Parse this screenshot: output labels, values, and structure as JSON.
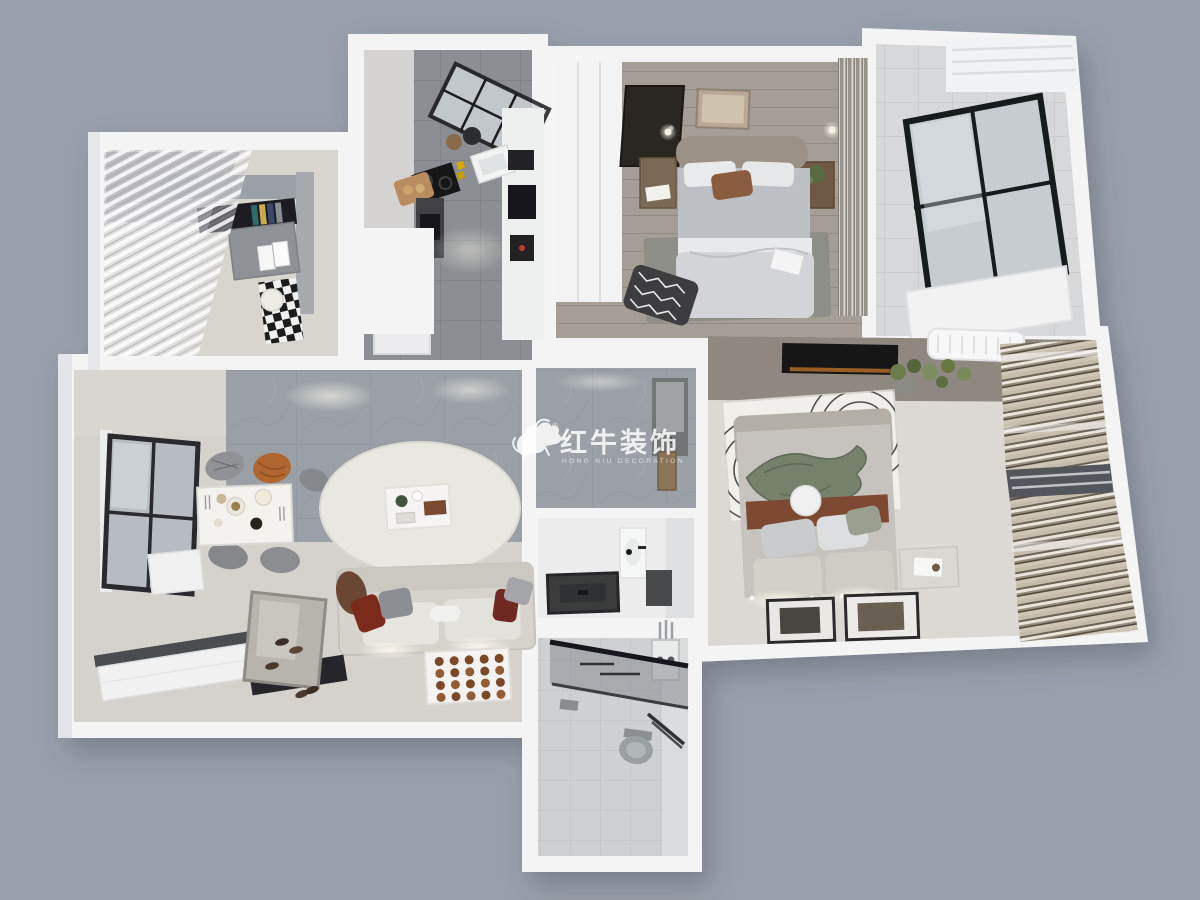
{
  "scene": {
    "type": "3d-floorplan-render",
    "description": "Photorealistic top-down 3D render of an apartment interior",
    "rooms": [
      {
        "id": "study-balcony"
      },
      {
        "id": "kitchen"
      },
      {
        "id": "bedroom-secondary"
      },
      {
        "id": "balcony-side"
      },
      {
        "id": "bedroom-master"
      },
      {
        "id": "living-dining"
      },
      {
        "id": "hallway"
      },
      {
        "id": "bathroom-vanity"
      },
      {
        "id": "bathroom-shower"
      }
    ]
  },
  "watermark": {
    "logo": "bull-logo",
    "registered": "®",
    "title": "红牛装饰",
    "subtitle": "HONG NIU DECORATION",
    "color": "#ffffff"
  },
  "palette": {
    "background": "#9aa0ab",
    "wall": "#f4f4f5",
    "wall_shade": "#e0e1e4",
    "study_floor": "#d8d5cf",
    "kitchen_floor": "#8b8e92",
    "bedroom1_floor": "#a49e96",
    "master_floor": "#dcd9d4",
    "master_wall": "#8f8880",
    "living_floor": "#d5d2ce",
    "marble_wall": "#9aa0a6",
    "balcony_tile": "#d7d8da",
    "bath_floor": "#ececed",
    "shower_tile": "#cfd0d2",
    "accent_red": "#7c2a1c",
    "accent_rust": "#b0662e",
    "accent_terracotta": "#7e4a33",
    "accent_green": "#6f7f4f",
    "dark_fixture": "#1d1e20",
    "wood": "#8a6f52"
  }
}
